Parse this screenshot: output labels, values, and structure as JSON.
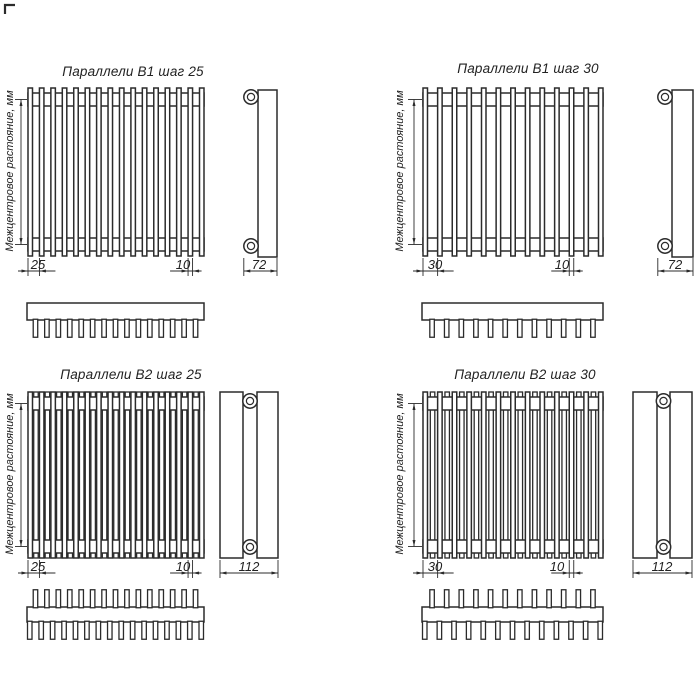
{
  "page": {
    "background": "#ffffff",
    "line_color": "#2b2b2b",
    "text_color": "#222222"
  },
  "quadrants": [
    {
      "title": "Параллели В1 шаг 25",
      "vertical_label": "Межцентровое растояние, мм",
      "pitch_label": "25",
      "tube_width_label": "10",
      "depth_label": "72",
      "front_tubes": 16,
      "back_tubes": 0,
      "teeth_below": 15,
      "teeth_above": 0
    },
    {
      "title": "Параллели В1 шаг 30",
      "vertical_label": "Межцентровое растояние, мм",
      "pitch_label": "30",
      "tube_width_label": "10",
      "depth_label": "72",
      "front_tubes": 13,
      "back_tubes": 0,
      "teeth_below": 12,
      "teeth_above": 0
    },
    {
      "title": "Параллели В2 шаг 25",
      "vertical_label": "Межцентровое растояние, мм",
      "pitch_label": "25",
      "tube_width_label": "10",
      "depth_label": "112",
      "front_tubes": 16,
      "back_tubes": 15,
      "teeth_below": 16,
      "teeth_above": 15
    },
    {
      "title": "Параллели В2 шаг 30",
      "vertical_label": "Межцентровое растояние, мм",
      "pitch_label": "30",
      "tube_width_label": "10",
      "depth_label": "112",
      "front_tubes": 13,
      "back_tubes": 12,
      "teeth_below": 13,
      "teeth_above": 12
    }
  ]
}
